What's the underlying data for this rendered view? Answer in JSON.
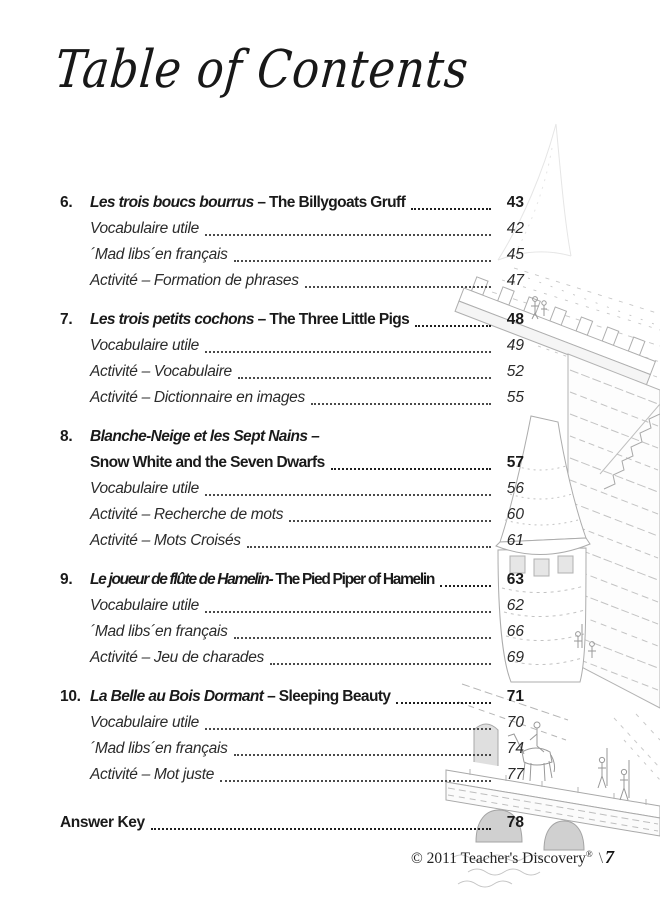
{
  "page": {
    "title": "Table of Contents"
  },
  "toc": {
    "sections": [
      {
        "number": "6.",
        "title_fr": "Les trois boucs bourrus",
        "title_en": " – The Billygoats Gruff",
        "page": "43",
        "items": [
          {
            "label": "Vocabulaire utile",
            "page": "42"
          },
          {
            "label": "´Mad libs´en français",
            "page": "45"
          },
          {
            "label": "Activité – Formation de phrases",
            "page": "47"
          }
        ]
      },
      {
        "number": "7.",
        "title_fr": "Les trois petits cochons",
        "title_en": " – The Three Little Pigs",
        "page": "48",
        "items": [
          {
            "label": "Vocabulaire utile",
            "page": "49"
          },
          {
            "label": "Activité – Vocabulaire",
            "page": "52"
          },
          {
            "label": "Activité – Dictionnaire en images",
            "page": "55"
          }
        ]
      },
      {
        "number": "8.",
        "title_fr": "Blanche-Neige et les Sept Nains –",
        "title_en": "Snow White and the Seven Dwarfs",
        "page": "57",
        "items": [
          {
            "label": "Vocabulaire utile",
            "page": "56"
          },
          {
            "label": "Activité – Recherche de mots",
            "page": "60"
          },
          {
            "label": "Activité – Mots Croisés",
            "page": "61"
          }
        ]
      },
      {
        "number": "9.",
        "title_fr": "Le joueur de flûte de Hamelin-",
        "title_en": " The Pied Piper of Hamelin",
        "page": "63",
        "items": [
          {
            "label": "Vocabulaire utile",
            "page": "62"
          },
          {
            "label": "´Mad libs´en français",
            "page": "66"
          },
          {
            "label": "Activité – Jeu de charades",
            "page": "69"
          }
        ]
      },
      {
        "number": "10.",
        "title_fr": "La Belle au Bois Dormant",
        "title_en": " – Sleeping Beauty",
        "page": "71",
        "items": [
          {
            "label": "Vocabulaire utile",
            "page": "70"
          },
          {
            "label": "´Mad libs´en français",
            "page": "74"
          },
          {
            "label": "Activité – Mot juste",
            "page": "77"
          }
        ]
      }
    ],
    "answer_key": {
      "label": "Answer Key",
      "page": "78"
    }
  },
  "footer": {
    "copyright": "© 2011 Teacher's Discovery",
    "reg": "®",
    "separator": "\\",
    "page_number": "7"
  },
  "illustration": {
    "name": "castle-bridge-pen-and-ink-drawing"
  }
}
